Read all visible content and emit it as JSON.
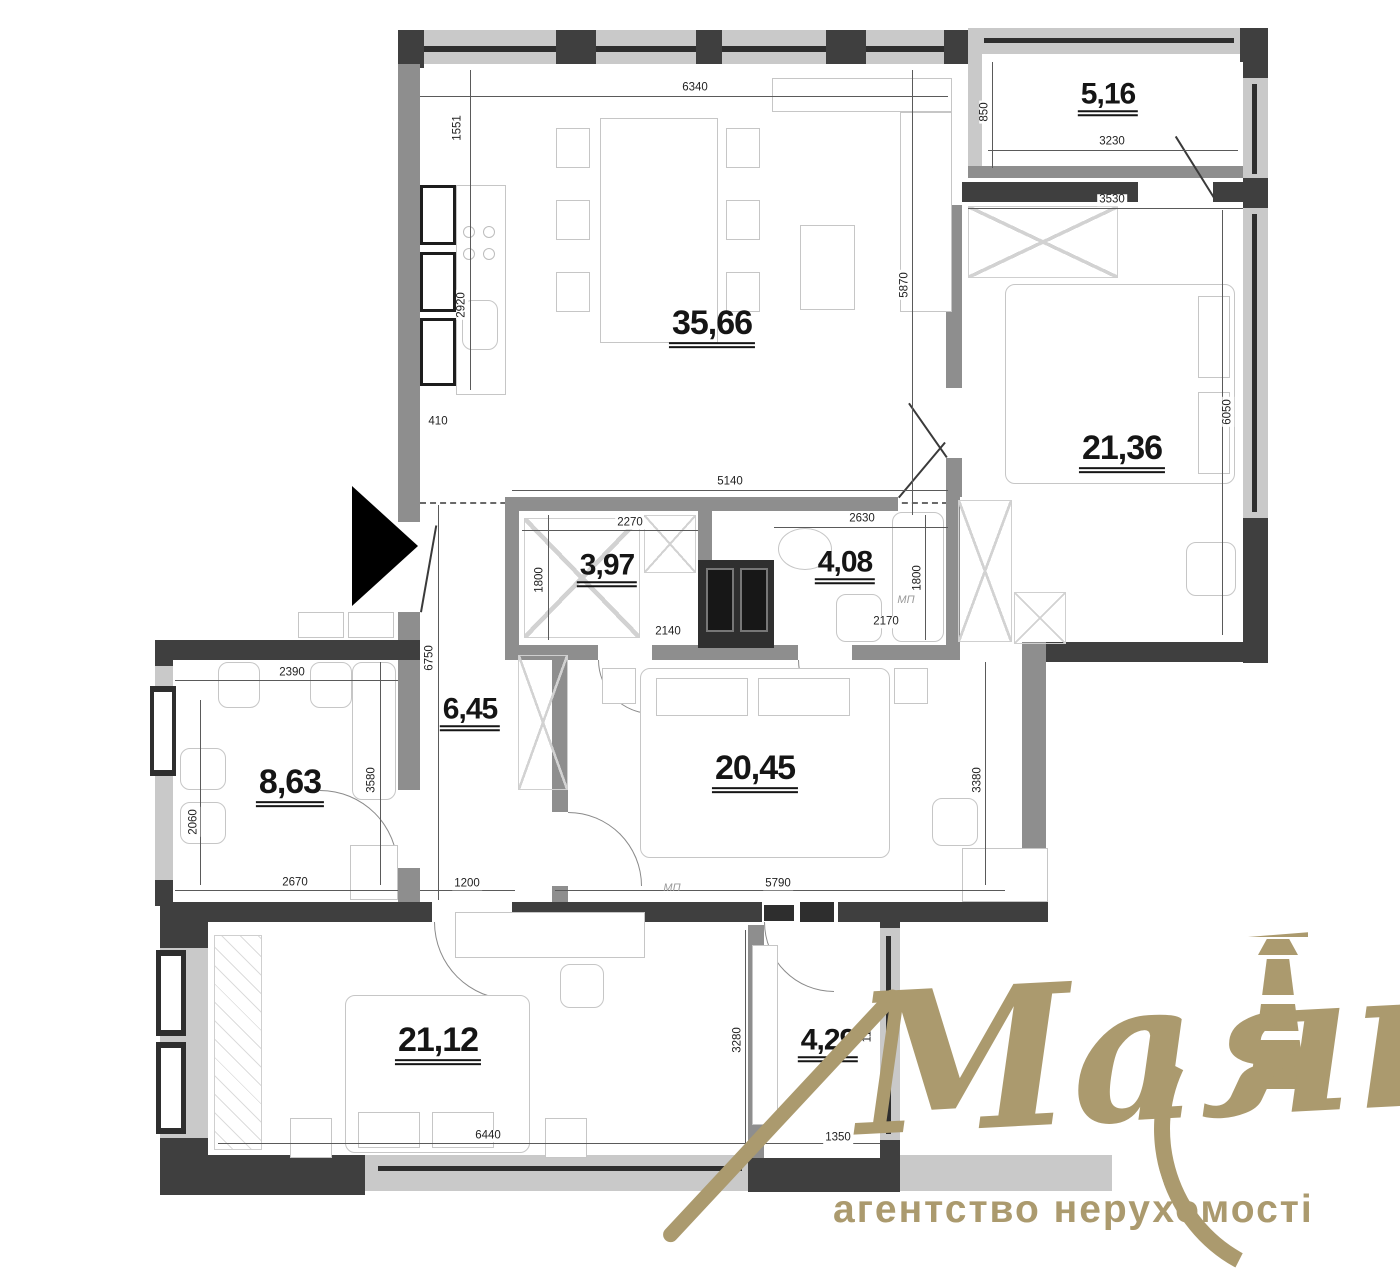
{
  "rooms": {
    "living": "35,66",
    "balcony_top": "5,16",
    "bedroom_right": "21,36",
    "bath_a": "3,97",
    "bath_b": "4,08",
    "hall": "6,45",
    "bath_left": "8,63",
    "bedroom_mid": "20,45",
    "bedroom_bottom": "21,12",
    "balcony_bottom": "4,29"
  },
  "dims": {
    "d6340": "6340",
    "d1551": "1551",
    "d2920": "2920",
    "d410": "410",
    "d850": "850",
    "d3230": "3230",
    "d3530": "3530",
    "d5870": "5870",
    "d6050": "6050",
    "d5140": "5140",
    "d2270": "2270",
    "d2630": "2630",
    "d1800L": "1800",
    "d1800R": "1800",
    "d2140": "2140",
    "d2170": "2170",
    "d6750": "6750",
    "d2390": "2390",
    "d3580": "3580",
    "d2060": "2060",
    "d2670": "2670",
    "d1200": "1200",
    "d5790": "5790",
    "d3380": "3380",
    "d3280": "3280",
    "d1180": "1180",
    "d6440": "6440",
    "d1350": "1350"
  },
  "labels": {
    "mp_bath": "МП",
    "mp_left": "МП"
  },
  "watermark": {
    "brand": "Маяк",
    "subtitle": "агентство нерухомості",
    "color": "#ab9a6e"
  }
}
